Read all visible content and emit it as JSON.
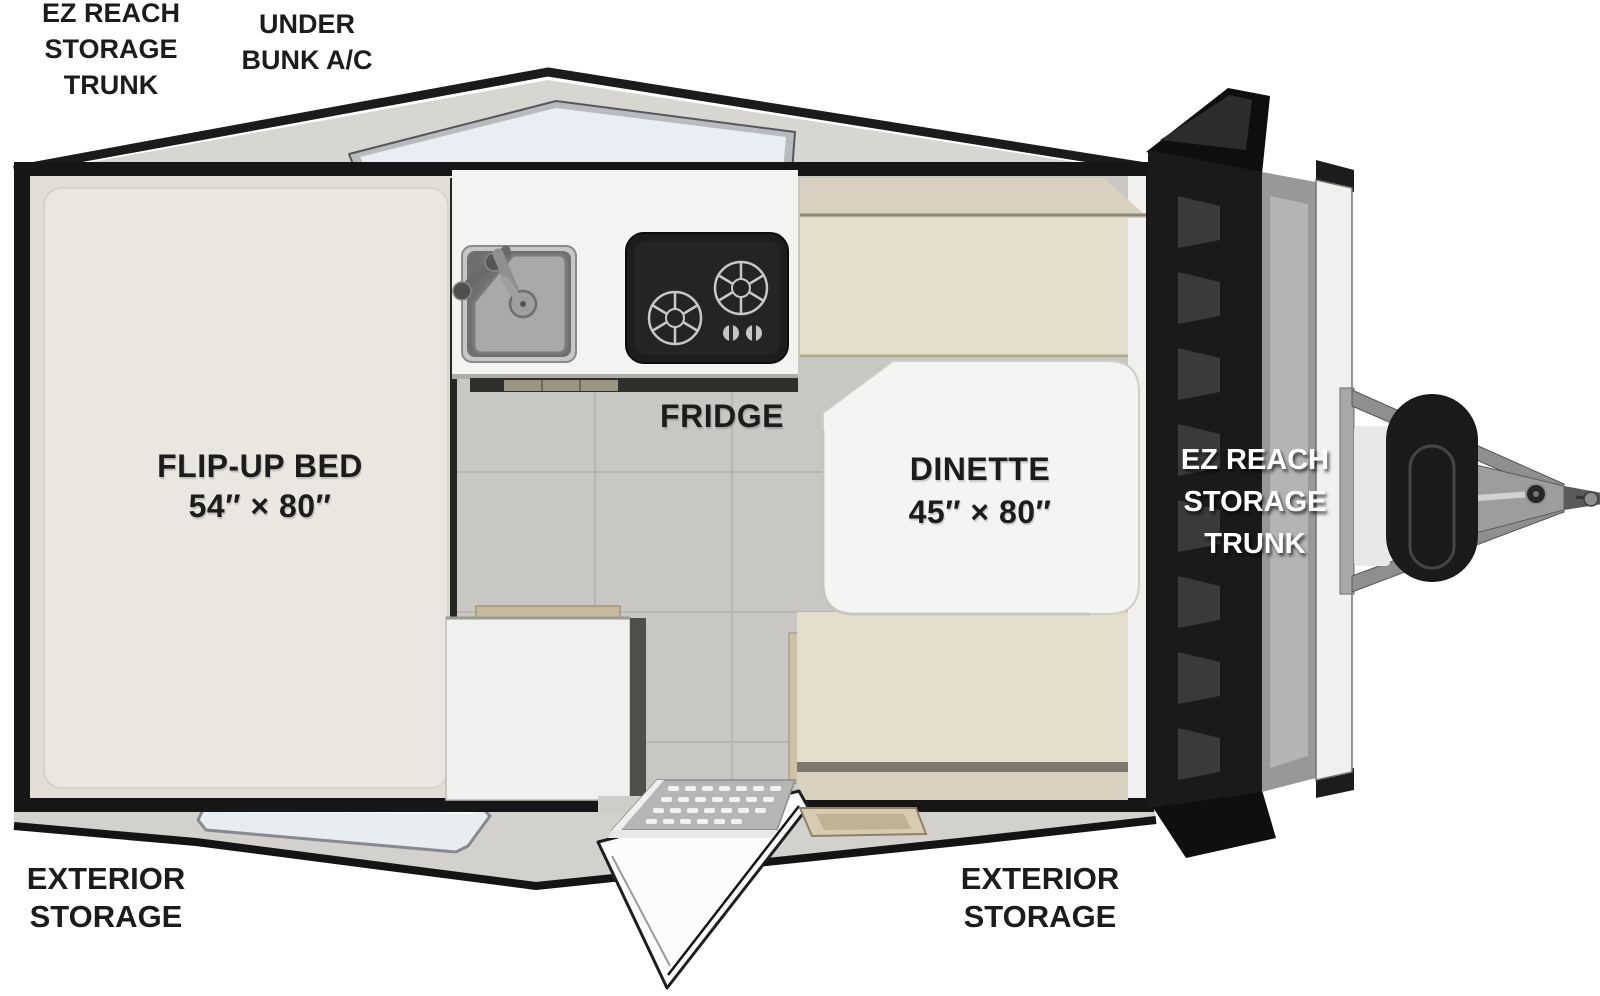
{
  "document": {
    "type": "travel-trailer floorplan (top-down diagram)"
  },
  "labels": {
    "front_trunk_callout": {
      "line1": "EZ REACH",
      "line2": "STORAGE",
      "line3": "TRUNK"
    },
    "under_bunk_ac": {
      "line1": "UNDER",
      "line2": "BUNK A/C"
    },
    "flip_up_bed": {
      "line1": "FLIP-UP BED",
      "line2": "54″ × 80″"
    },
    "fridge": "FRIDGE",
    "dinette": {
      "line1": "DINETTE",
      "line2": "45″ × 80″"
    },
    "ez_reach_trunk": {
      "line1": "EZ REACH",
      "line2": "STORAGE",
      "line3": "TRUNK"
    },
    "exterior_storage_left": {
      "line1": "EXTERIOR",
      "line2": "STORAGE"
    },
    "exterior_storage_right": {
      "line1": "EXTERIOR",
      "line2": "STORAGE"
    }
  },
  "fixtures": [
    "skylight-window",
    "flip-up-bed",
    "kitchen-sink",
    "two-burner-stove",
    "under-counter-fridge",
    "storage-cabinet",
    "dinette-table",
    "dinette-bench-seats",
    "entry-step-grate",
    "entry-door-open",
    "entry-mat",
    "bed-side-window",
    "ez-reach-storage-trunk-door",
    "a-frame-tongue",
    "tongue-jack-cover",
    "hitch-coupler"
  ],
  "colors": {
    "outline": "#161616",
    "roof_band": "#d8d6d1",
    "glass": "#e8eef3",
    "interior_wall": "#e2ded6",
    "bed_surface": "#eae7e0",
    "tile_floor": "#c9c7c3",
    "counter": "#f3f3f1",
    "stove": "#1d1d1d",
    "cushion_seat": "#e5ddcc",
    "cushion_backrest": "#d9d0bf",
    "cushion_edge": "#8d8679",
    "table": "#f4f4f2",
    "trunk_black": "#1a1a1a",
    "trunk_silver": "#989898",
    "exterior_band": "#d3d1cd",
    "mat": "#d7cbb1",
    "label_text": "#1c1c1c",
    "trunk_label_text": "#ffffff"
  }
}
